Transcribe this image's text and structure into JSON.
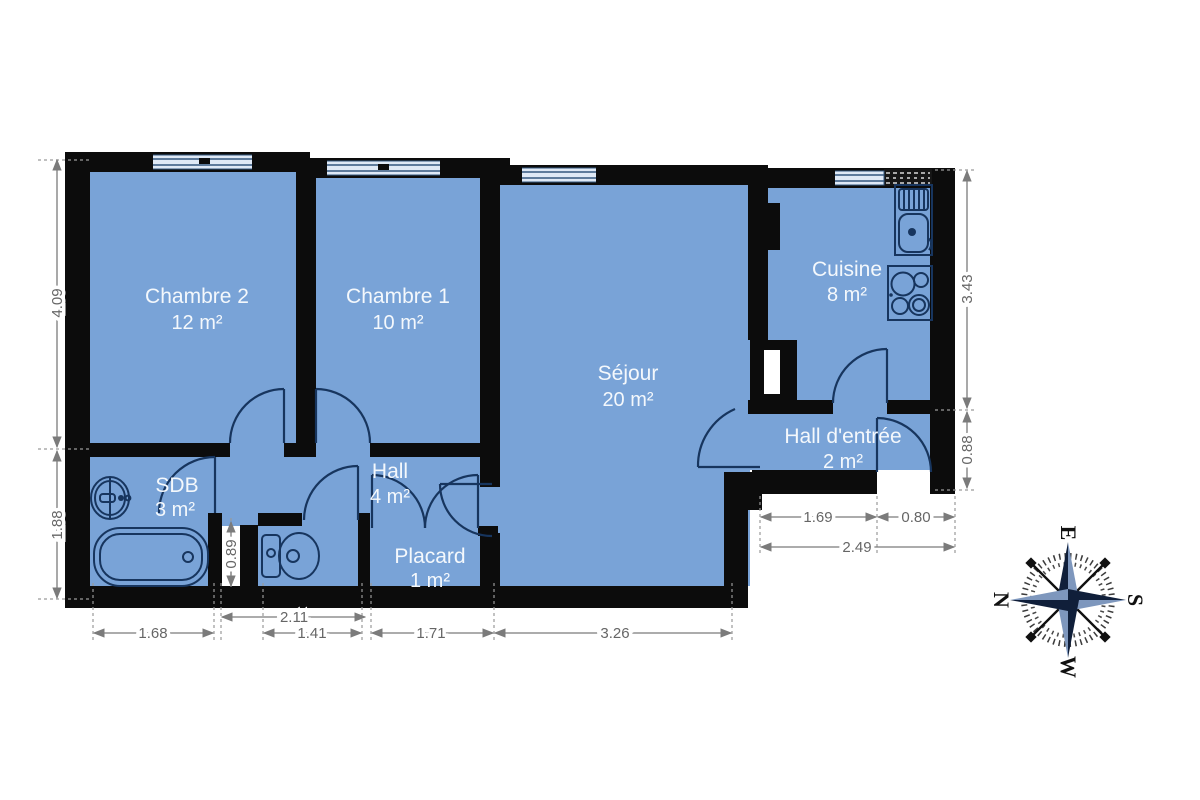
{
  "rooms": {
    "chambre2": {
      "name": "Chambre 2",
      "area": "12 m²"
    },
    "chambre1": {
      "name": "Chambre 1",
      "area": "10 m²"
    },
    "sejour": {
      "name": "Séjour",
      "area": "20 m²"
    },
    "cuisine": {
      "name": "Cuisine",
      "area": "8 m²"
    },
    "hall_entree": {
      "name": "Hall d'entrée",
      "area": "2 m²"
    },
    "hall": {
      "name": "Hall",
      "area": "4 m²"
    },
    "sdb": {
      "name": "SDB",
      "area": "3 m²"
    },
    "placard": {
      "name": "Placard",
      "area": "1 m²"
    }
  },
  "dimensions": {
    "left_upper": "4.09",
    "left_lower": "1.88",
    "right_upper": "3.43",
    "right_lower": "0.88",
    "entry_left": "1.69",
    "entry_door": "0.80",
    "entry_total": "2.49",
    "bath_width": "1.68",
    "wc_zone_width": "2.11",
    "wc_width": "1.41",
    "placard_width": "1.71",
    "sejour_width": "3.26",
    "duct_opening": "0.89"
  },
  "compass": {
    "top": "E",
    "right": "S",
    "bottom": "W",
    "left": "N"
  },
  "colors": {
    "floor": "#79a3d7",
    "wall": "#0c0c0c",
    "fixture_line": "#17355e",
    "dimension_text": "#666666",
    "window_fill": "#dfe9f6",
    "label_text": "#f4f8fc"
  }
}
